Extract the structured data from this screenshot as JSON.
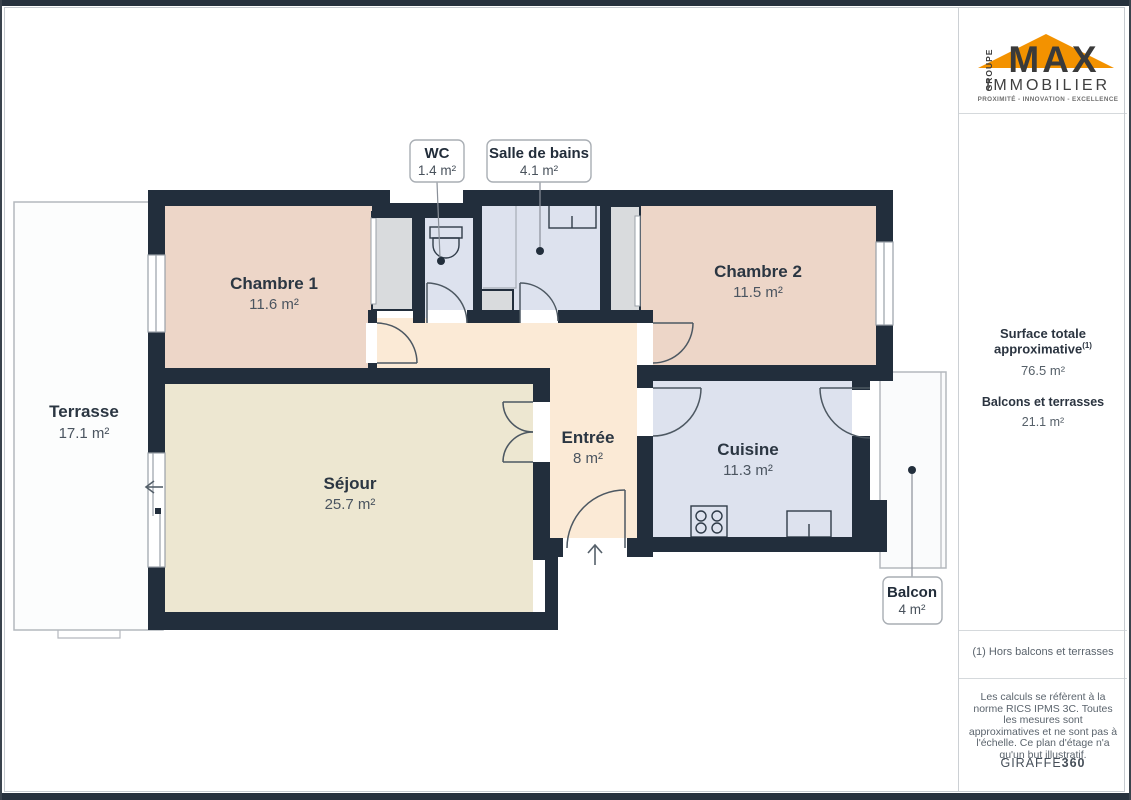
{
  "branding": {
    "groupe": "GROUPE",
    "name": "MAX",
    "subtitle": "IMMOBILIER",
    "tagline": "PROXIMITÉ - INNOVATION - EXCELLENCE"
  },
  "sidebar": {
    "surface_title": "Surface totale approximative",
    "surface_footnote_ref": "(1)",
    "surface_value": "76.5 m²",
    "balconies_title": "Balcons et terrasses",
    "balconies_value": "21.1 m²",
    "footnote": "(1) Hors balcons et terrasses",
    "disclaimer": "Les calculs se réfèrent à la norme RICS IPMS 3C. Toutes les mesures sont approximatives et ne sont pas à l'échelle. Ce plan d'étage n'a qu'un but illustratif.",
    "credit_name": "GIRAFFE",
    "credit_suffix": "360"
  },
  "plan": {
    "rooms": {
      "chambre1": {
        "name": "Chambre 1",
        "area": "11.6 m²"
      },
      "chambre2": {
        "name": "Chambre 2",
        "area": "11.5 m²"
      },
      "sejour": {
        "name": "Séjour",
        "area": "25.7 m²"
      },
      "entree": {
        "name": "Entrée",
        "area": "8 m²"
      },
      "cuisine": {
        "name": "Cuisine",
        "area": "11.3 m²"
      },
      "terrasse": {
        "name": "Terrasse",
        "area": "17.1 m²"
      }
    },
    "callouts": {
      "wc": {
        "name": "WC",
        "area": "1.4 m²"
      },
      "salle_de_bains": {
        "name": "Salle de bains",
        "area": "4.1 m²"
      },
      "balcon": {
        "name": "Balcon",
        "area": "4 m²"
      }
    }
  },
  "colors": {
    "wall": "#222E3C",
    "bedroom_fill": "#EDD6C8",
    "living_fill": "#EDE7D1",
    "hall_fill": "#FBEAD6",
    "wet_room_fill": "#DDE2EE",
    "closet_fill": "#D9DBDD",
    "outdoor_outline": "#B4B8BD",
    "logo_orange": "#F39200",
    "logo_dark": "#3A3A3A"
  }
}
